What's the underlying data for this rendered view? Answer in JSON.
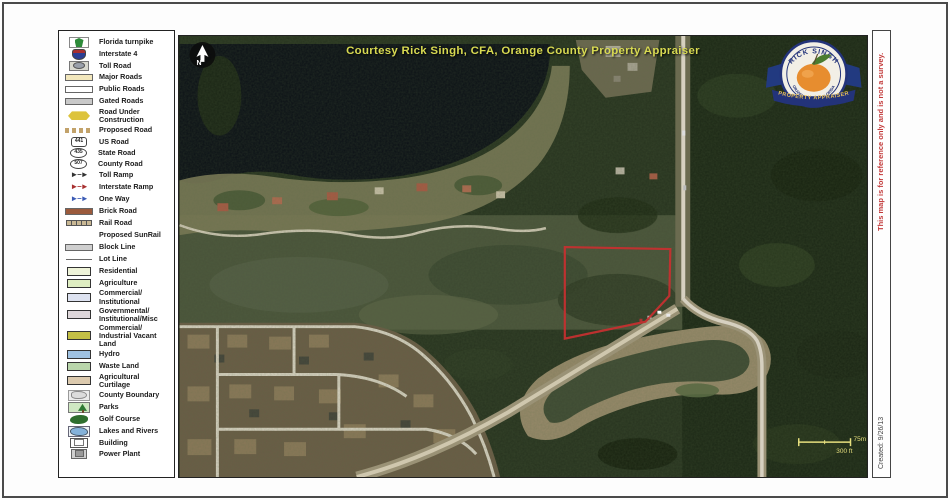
{
  "window": {
    "disclaimer": "This map is for reference only and is not a survey.",
    "created": "Created: 9/26/13"
  },
  "map": {
    "credit": "Courtesy Rick Singh, CFA, Orange County Property Appraiser",
    "north_label": "N",
    "scale_metric": "75m",
    "scale_imperial": "300 ft",
    "logo": {
      "name": "RICK SINGH",
      "county": "ORANGE COUNTY FLORIDA",
      "title": "PROPERTY APPRAISER"
    }
  },
  "colors": {
    "parcel_outline": "#c53030",
    "credit_text": "#d8da52",
    "disclaimer_text": "#c23a3a",
    "scale_text": "#e6df7e"
  },
  "legend": {
    "items": [
      {
        "label": "Florida turnpike",
        "icon": "shield-green"
      },
      {
        "label": "Interstate 4",
        "icon": "shield-interstate"
      },
      {
        "label": "Toll Road",
        "icon": "toll-road"
      },
      {
        "label": "Major Roads",
        "icon": "bar",
        "color": "#f2e7bc"
      },
      {
        "label": "Public Roads",
        "icon": "bar",
        "color": "#ffffff"
      },
      {
        "label": "Gated Roads",
        "icon": "bar",
        "color": "#c9c9c9"
      },
      {
        "label": "Road Under Construction",
        "icon": "diamond",
        "color": "#ddc33c"
      },
      {
        "label": "Proposed Road",
        "icon": "dashed",
        "color": "#c2a26a"
      },
      {
        "label": "US Road",
        "icon": "route-shield",
        "text": "441"
      },
      {
        "label": "State Road",
        "icon": "route-oval",
        "text": "435"
      },
      {
        "label": "County Road",
        "icon": "route-oval",
        "text": "507"
      },
      {
        "label": "Toll Ramp",
        "icon": "arrows",
        "color": "#333333"
      },
      {
        "label": "Interstate Ramp",
        "icon": "arrows",
        "color": "#a83030"
      },
      {
        "label": "One Way",
        "icon": "arrows",
        "color": "#3b5bb5"
      },
      {
        "label": "Brick Road",
        "icon": "bar",
        "color": "#9b5a3c"
      },
      {
        "label": "Rail Road",
        "icon": "rail"
      },
      {
        "label": "Proposed SunRail",
        "icon": "none"
      },
      {
        "label": "Block Line",
        "icon": "bar",
        "color": "#cfcfcf"
      },
      {
        "label": "Lot Line",
        "icon": "line"
      },
      {
        "label": "Residential",
        "icon": "swatch",
        "color": "#eef3d8"
      },
      {
        "label": "Agriculture",
        "icon": "swatch",
        "color": "#dfeec2"
      },
      {
        "label": "Commercial/ Institutional",
        "icon": "swatch",
        "color": "#dde2f0"
      },
      {
        "label": "Governmental/ Institutional/Misc",
        "icon": "swatch",
        "color": "#ded7da"
      },
      {
        "label": "Commercial/ Industrial Vacant Land",
        "icon": "swatch",
        "color": "#c3bf45"
      },
      {
        "label": "Hydro",
        "icon": "swatch",
        "color": "#9fc2e2"
      },
      {
        "label": "Waste Land",
        "icon": "swatch",
        "color": "#b9d6ab"
      },
      {
        "label": "Agricultural Curtilage",
        "icon": "swatch",
        "color": "#dccaae"
      },
      {
        "label": "County Boundary",
        "icon": "county"
      },
      {
        "label": "Parks",
        "icon": "tree"
      },
      {
        "label": "Golf Course",
        "icon": "golf"
      },
      {
        "label": "Lakes and Rivers",
        "icon": "water"
      },
      {
        "label": "Building",
        "icon": "building"
      },
      {
        "label": "Power Plant",
        "icon": "powerplant"
      }
    ]
  }
}
